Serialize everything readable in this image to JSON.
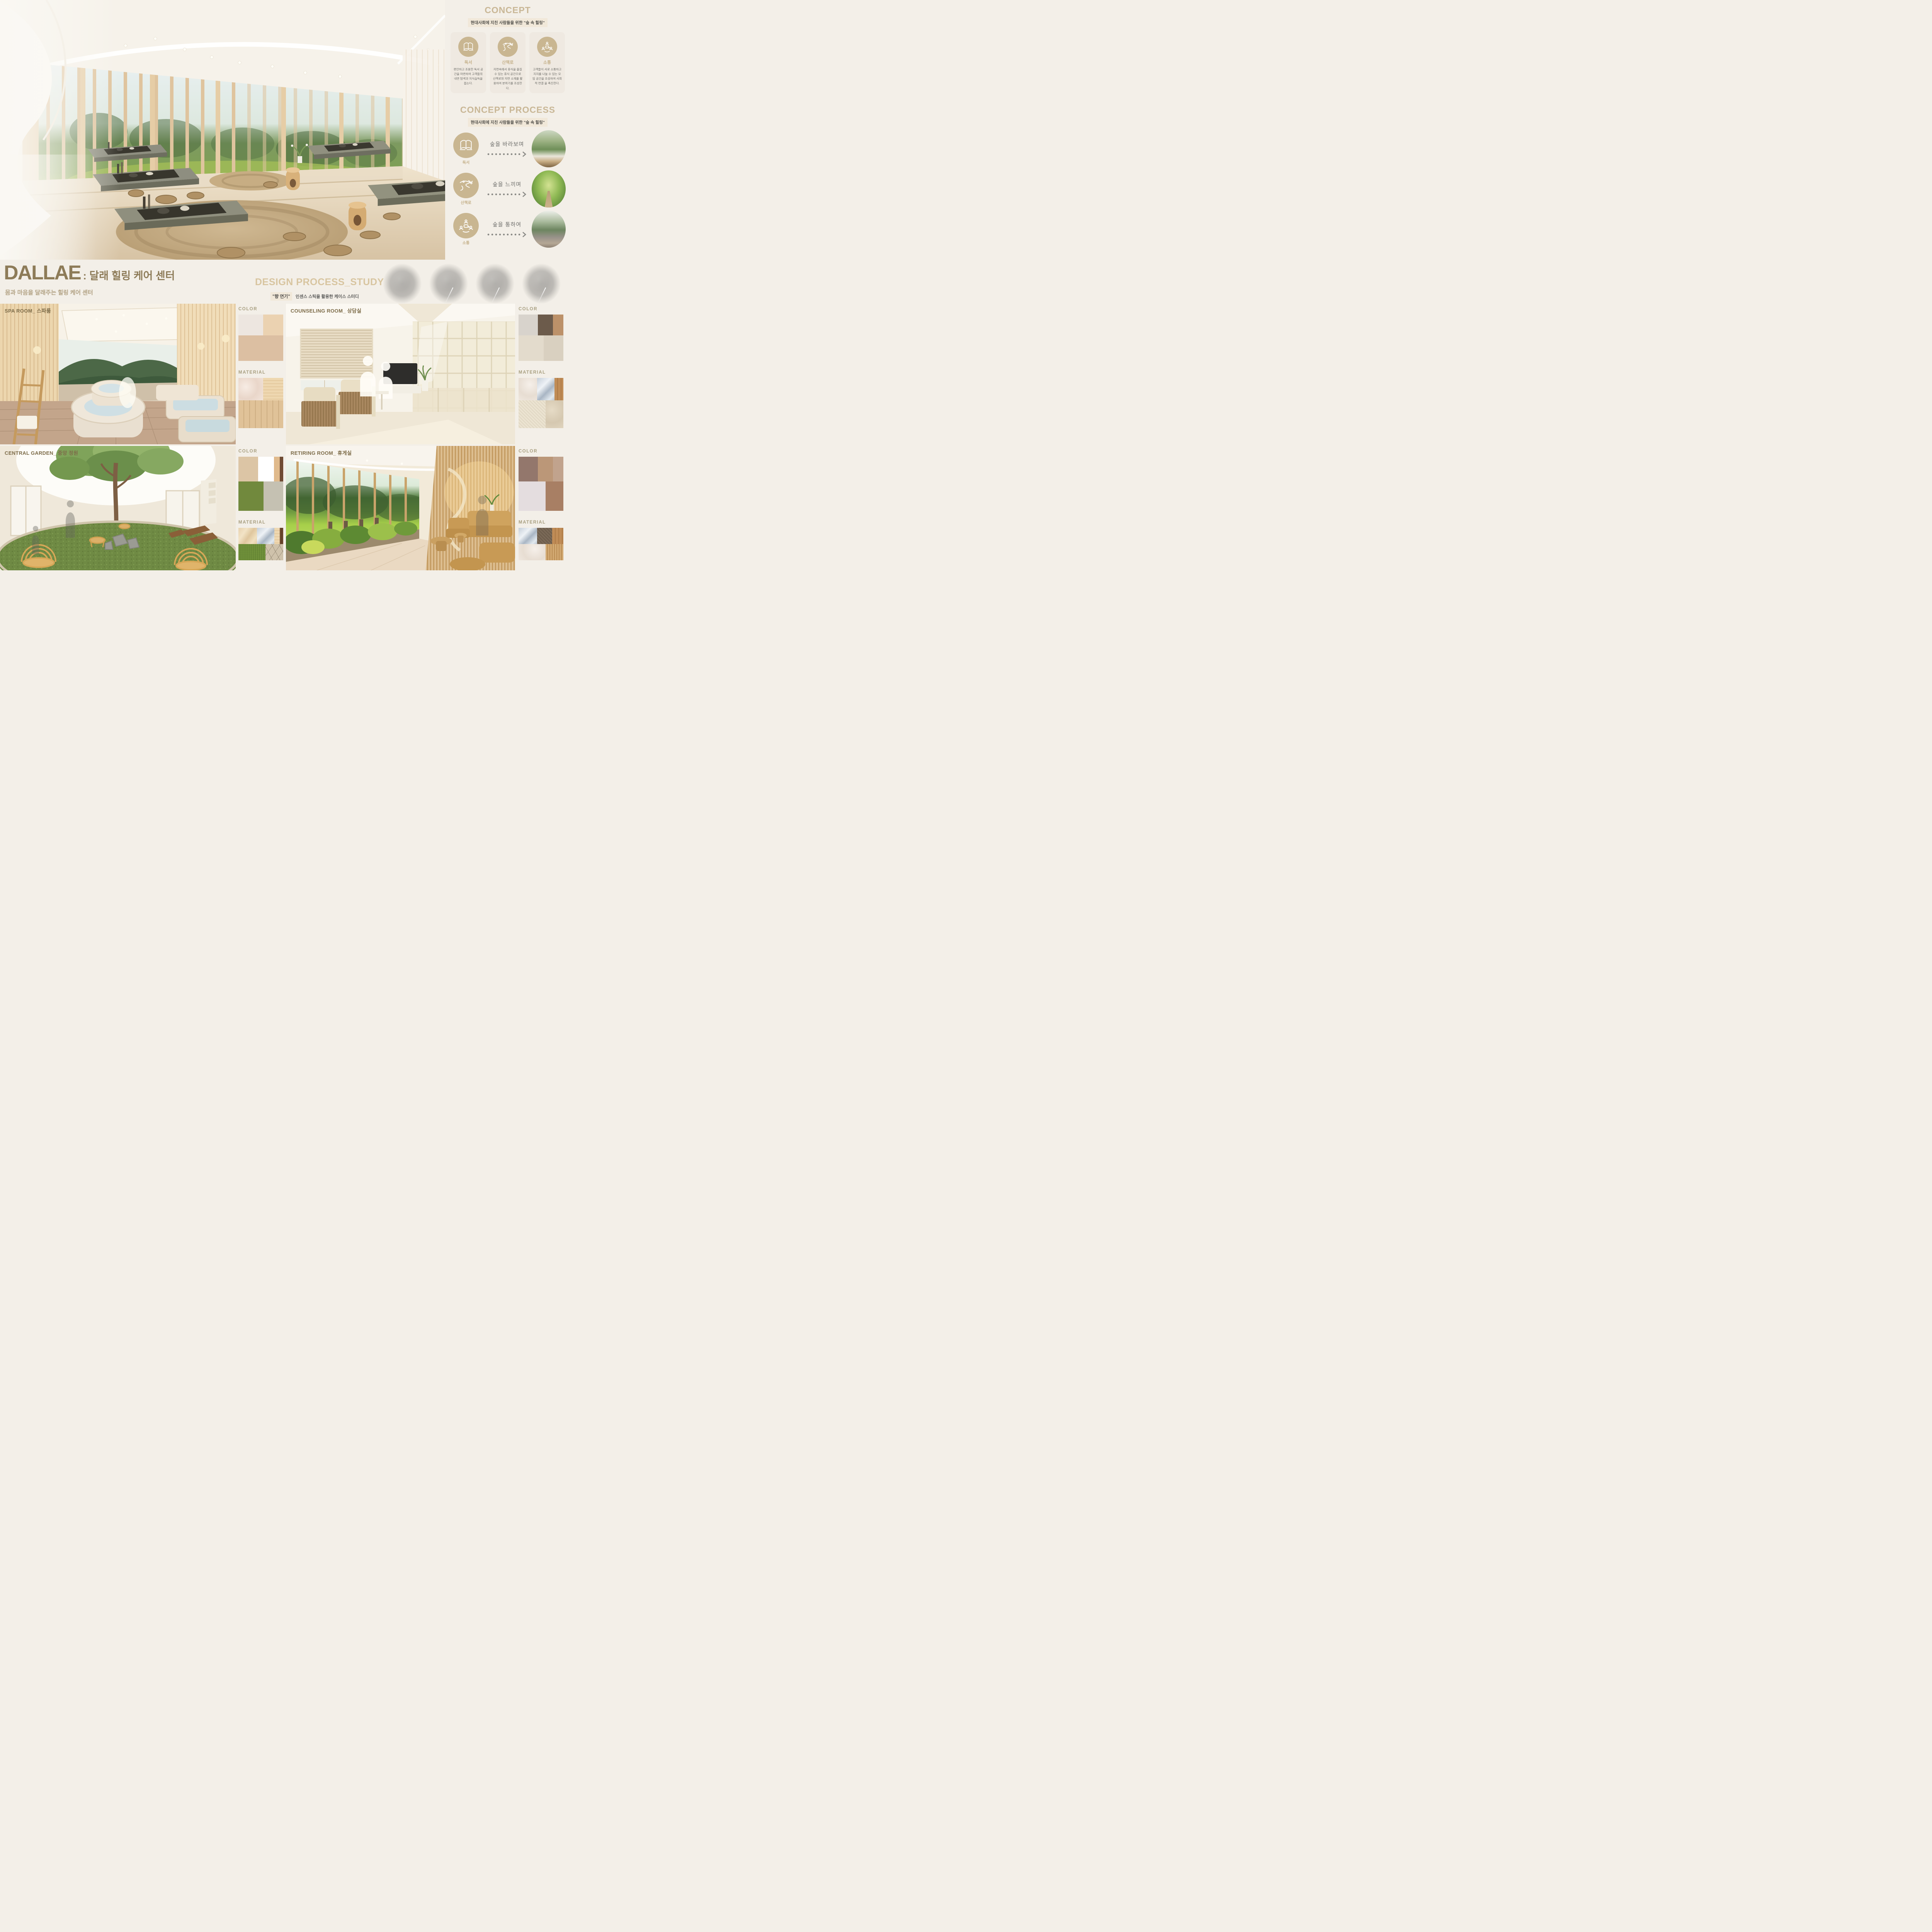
{
  "concept": {
    "title": "CONCEPT",
    "subtitle": "현대사회에 지친 사람들을 위한 \"숲 속 힐링\"",
    "cards": [
      {
        "icon": "book-icon",
        "label": "독서",
        "desc": "편안하고 조용한 독서 공간을 마련하여 고객들의 내면 탐색과 지식습득을 돕는다."
      },
      {
        "icon": "trail-icon",
        "label": "산책로",
        "desc": "자연속에서 휴식을 즐길수 있는 휴식 공간으로 산책로와 자연 소재를 활용하여 분위기를 조성한다."
      },
      {
        "icon": "communication-icon",
        "label": "소통",
        "desc": "고객들이 서로 소통하고 지지를 나눌 수 있는 모임 공간을 조성하여 사회적 연결 을 촉진한다."
      }
    ]
  },
  "concept_process": {
    "title": "CONCEPT PROCESS",
    "subtitle": "현대사회에 지친 사람들을 위한 \"숲 속 힐링\"",
    "rows": [
      {
        "icon": "book-icon",
        "label": "독서",
        "text": "숲을 바라보며",
        "photo": "forest-window-study"
      },
      {
        "icon": "trail-icon",
        "label": "산책로",
        "text": "숲을 느끼며",
        "photo": "forest-path"
      },
      {
        "icon": "communication-icon",
        "label": "소통",
        "text": "숲을 통하여",
        "photo": "glass-forest-lounge"
      }
    ]
  },
  "title_block": {
    "en": "DALLAE",
    "kr": ": 달래 힐링 케어 센터",
    "subtitle": "몸과 마음을 달래주는 힐링 케어 센터"
  },
  "design_process": {
    "title": "DESIGN PROCESS_STUDY",
    "tag": "\"향 연기\"",
    "desc": "인센스 스틱을 활용한 케이스 스터디"
  },
  "rooms": [
    {
      "label": "SPA ROOM_ 스파룸",
      "color_title": "COLOR",
      "material_title": "MATERIAL",
      "colors": [
        {
          "cells": [
            {
              "color": "#EDE6E0",
              "w": 55
            },
            {
              "color": "#EBD2B1",
              "w": 45
            }
          ]
        },
        {
          "cells": [
            {
              "color": "#DCBFA2",
              "w": 100
            }
          ]
        }
      ],
      "materials": [
        {
          "cells": [
            {
              "tex": "marble-pink",
              "w": 55
            },
            {
              "tex": "wood-maple",
              "w": 45
            }
          ]
        },
        {
          "cells": [
            {
              "tex": "wood-plank",
              "w": 100
            }
          ]
        }
      ]
    },
    {
      "label": "COUNSELING ROOM_ 상담실",
      "color_title": "COLOR",
      "material_title": "MATERIAL",
      "colors": [
        {
          "cells": [
            {
              "color": "#D8D3CC",
              "w": 43
            },
            {
              "color": "#6C5B4B",
              "w": 34
            },
            {
              "color": "#BC9169",
              "w": 23
            }
          ]
        },
        {
          "cells": [
            {
              "color": "#E3DBCC",
              "w": 56
            },
            {
              "color": "#D9D0C0",
              "w": 44
            }
          ]
        }
      ],
      "materials": [
        {
          "cells": [
            {
              "tex": "marble-light",
              "w": 41
            },
            {
              "tex": "metal",
              "w": 39
            },
            {
              "tex": "wood-oak",
              "w": 20
            }
          ]
        },
        {
          "cells": [
            {
              "tex": "fabric-cream",
              "w": 60
            },
            {
              "tex": "stone-beige",
              "w": 40
            }
          ]
        }
      ]
    },
    {
      "label": "CENTRAL GARDEN_ 중앙 정원",
      "color_title": "COLOR",
      "material_title": "MATERIAL",
      "colors": [
        {
          "cells": [
            {
              "color": "#DCC5A5",
              "w": 44
            },
            {
              "color": "#FFFFFF",
              "w": 35
            },
            {
              "color": "#E0BA8C",
              "w": 13
            },
            {
              "color": "#6F4B33",
              "w": 8
            }
          ]
        },
        {
          "cells": [
            {
              "color": "#71893D",
              "w": 56
            },
            {
              "color": "#C5C1B2",
              "w": 44
            }
          ]
        }
      ],
      "materials": [
        {
          "cells": [
            {
              "tex": "marble-beige",
              "w": 41
            },
            {
              "tex": "metal",
              "w": 39
            },
            {
              "tex": "wood-maple",
              "w": 12
            },
            {
              "tex": "wood-dark",
              "w": 8
            }
          ]
        },
        {
          "cells": [
            {
              "tex": "grass",
              "w": 60
            },
            {
              "tex": "stone-pave",
              "w": 40
            }
          ]
        }
      ]
    },
    {
      "label": "RETIRING ROOM_ 휴게실",
      "color_title": "COLOR",
      "material_title": "MATERIAL",
      "colors": [
        {
          "cells": [
            {
              "color": "#93776C",
              "w": 43
            },
            {
              "color": "#BB9778",
              "w": 34
            },
            {
              "color": "#C1A38D",
              "w": 23
            }
          ]
        },
        {
          "cells": [
            {
              "color": "#E4DDDF",
              "w": 60
            },
            {
              "color": "#A87F64",
              "w": 40
            }
          ]
        }
      ],
      "materials": [
        {
          "cells": [
            {
              "tex": "metal",
              "w": 41
            },
            {
              "tex": "fabric-brown",
              "w": 34
            },
            {
              "tex": "wood-oak",
              "w": 25
            }
          ]
        },
        {
          "cells": [
            {
              "tex": "marble-light",
              "w": 60
            },
            {
              "tex": "wood-slat",
              "w": 40
            }
          ]
        }
      ]
    }
  ]
}
